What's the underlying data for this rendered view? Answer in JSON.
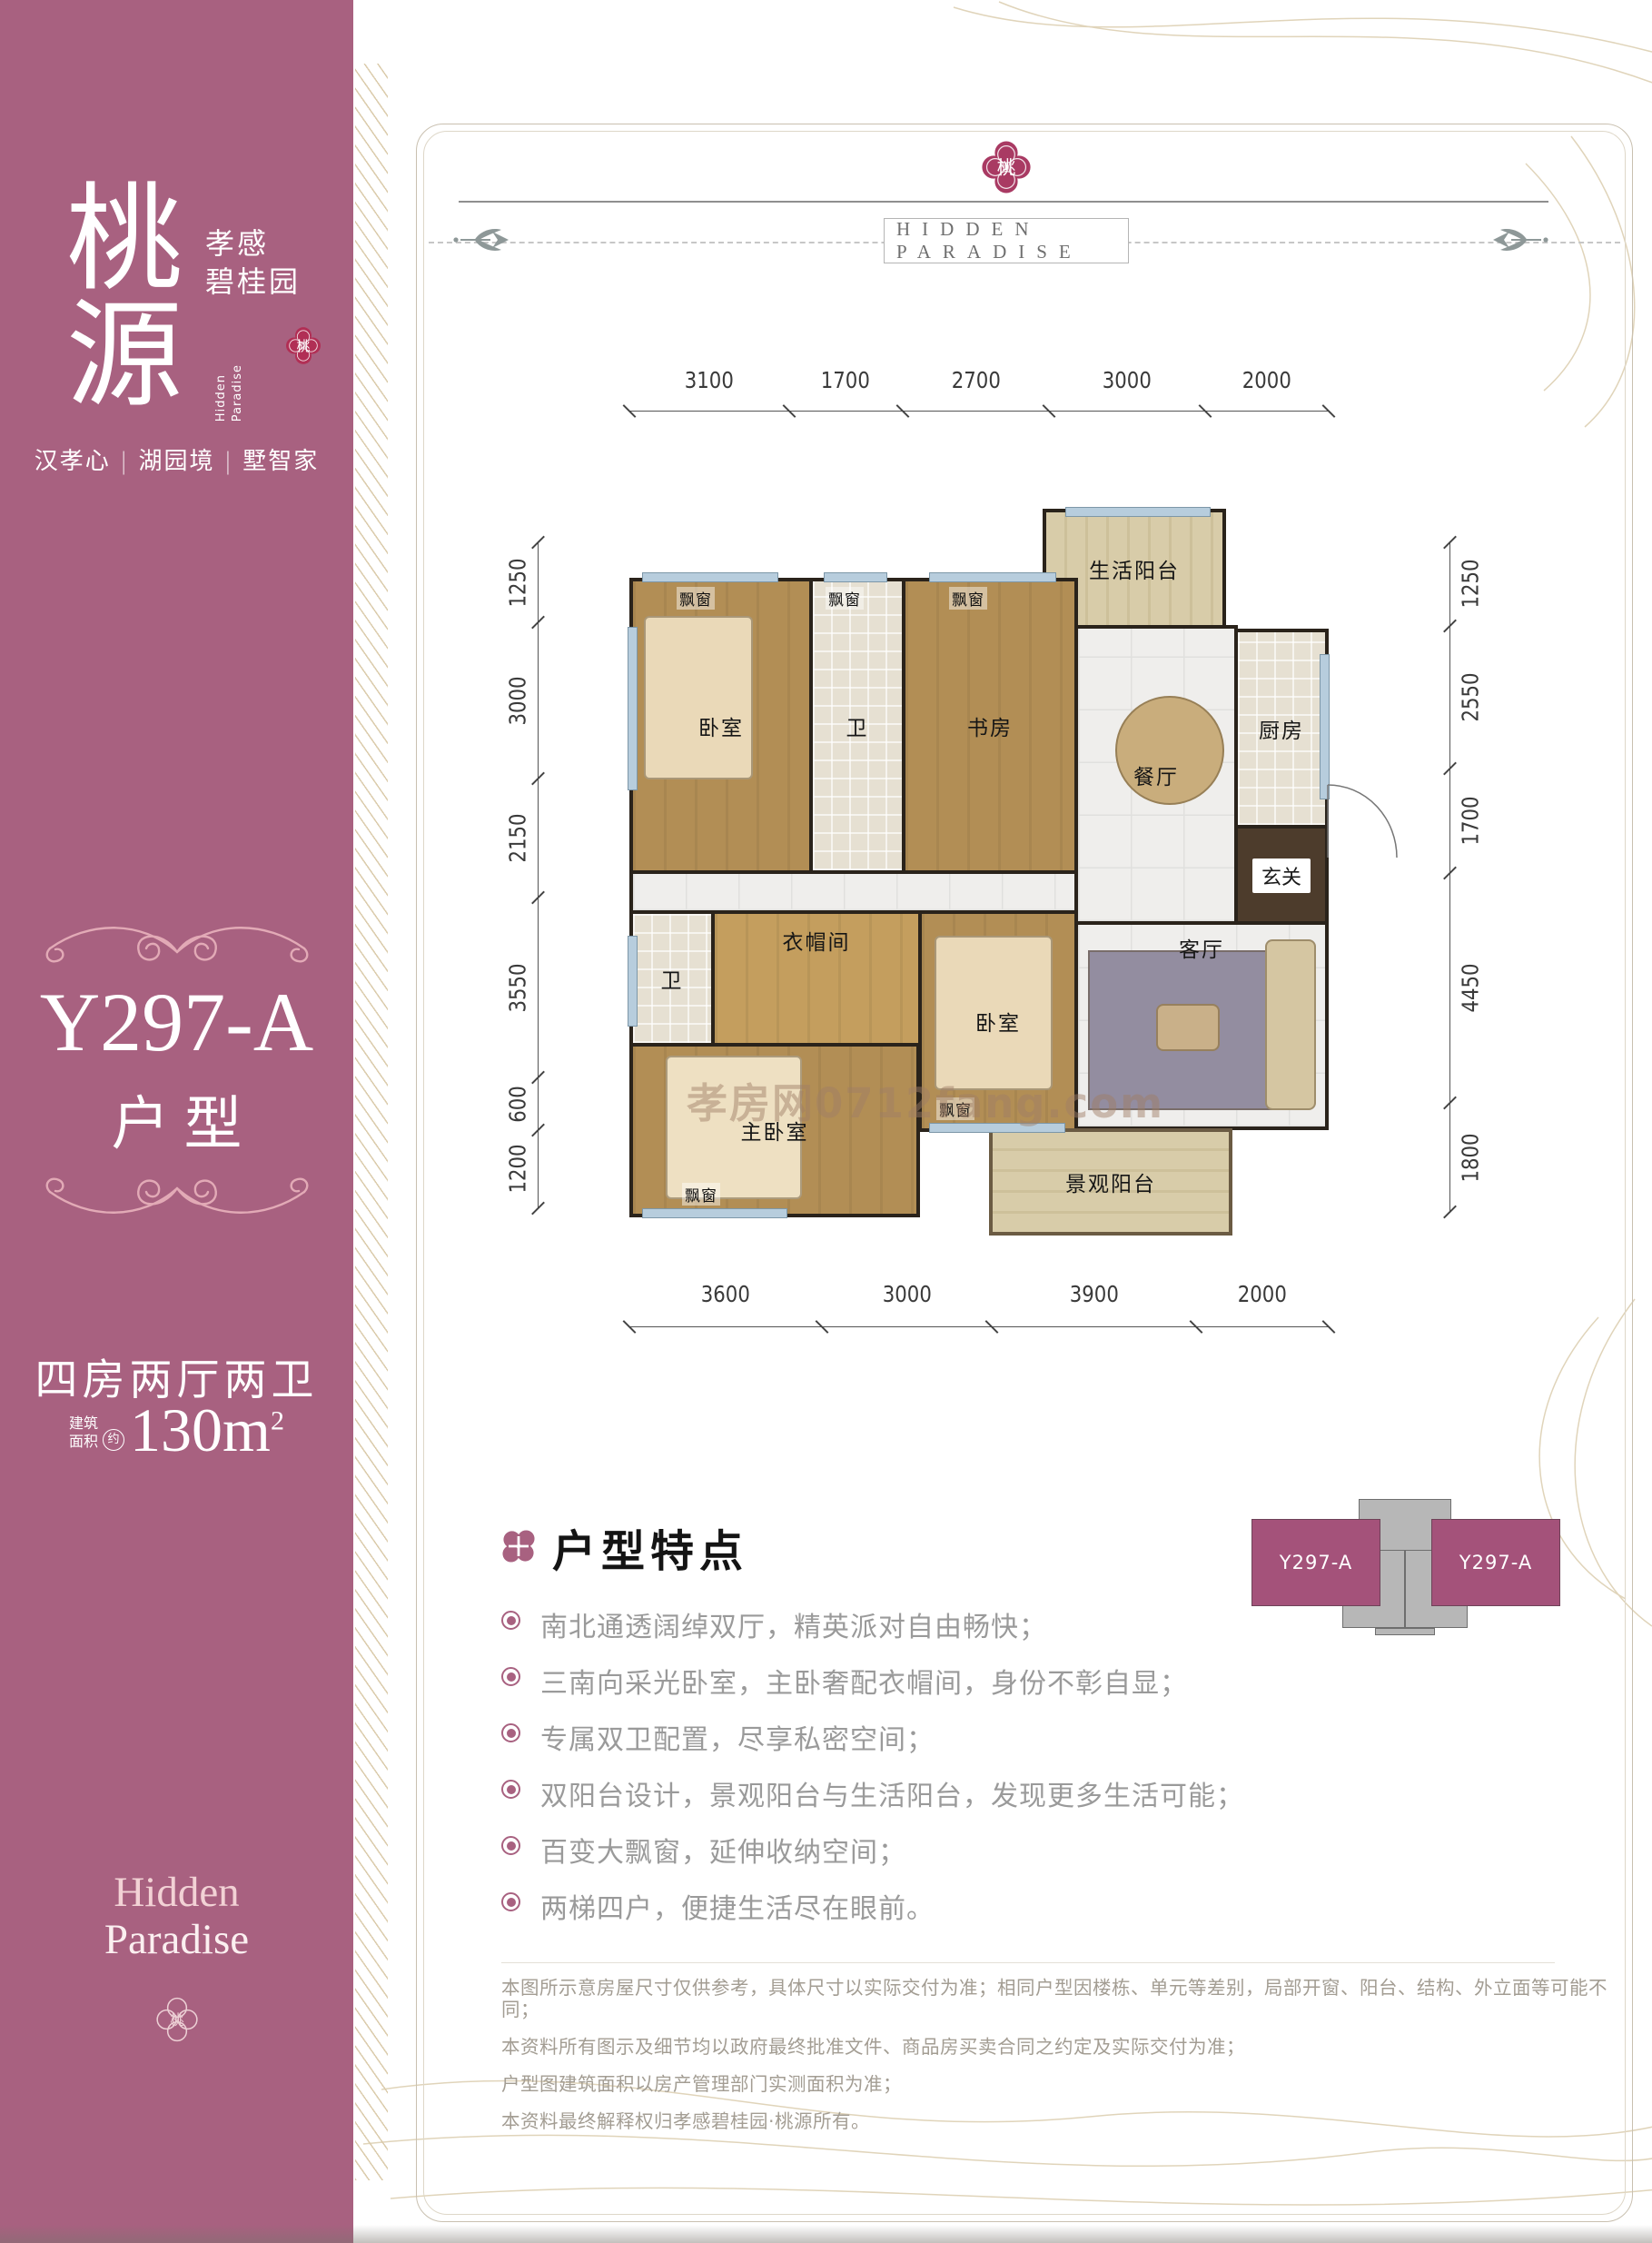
{
  "colors": {
    "sidebar_pink": "#a86180",
    "seal_red": "#b12f55",
    "seal_plum": "#a93a63",
    "gold_line": "#dbcdae",
    "keyplan_pink": "#a4527a"
  },
  "sidebar": {
    "logo_chars": [
      "桃",
      "源"
    ],
    "brand_lines": [
      "孝感",
      "碧桂园"
    ],
    "brand_en": "Hidden Paradise",
    "seal_char": "桃",
    "tagline": [
      "汉孝心",
      "湖园境",
      "墅智家"
    ],
    "tagline_sep": "|",
    "unit_code": "Y297-A",
    "unit_type_label": "户型",
    "layout_summary": "四房两厅两卫",
    "area_label_lines": [
      "建筑",
      "面积"
    ],
    "area_approx": "约",
    "area_value": "130m",
    "area_exp": "2",
    "footer_lines": [
      "Hidden",
      "Paradise"
    ]
  },
  "header": {
    "seal_char": "桃",
    "title": "HIDDEN PARADISE"
  },
  "floor_plan": {
    "dimensions": {
      "top": [
        3100,
        1700,
        2700,
        3000,
        2000
      ],
      "bottom": [
        3600,
        3000,
        3900,
        2000
      ],
      "left": [
        1250,
        3000,
        2150,
        3550,
        600,
        1200
      ],
      "right": [
        1250,
        2550,
        1700,
        4450,
        1800
      ]
    },
    "rooms": {
      "living_balcony": "生活阳台",
      "bedroom1": "卧室",
      "bath1": "卫",
      "study": "书房",
      "dining": "餐厅",
      "kitchen": "厨房",
      "foyer": "玄关",
      "living": "客厅",
      "bath2": "卫",
      "closet": "衣帽间",
      "master": "主卧室",
      "bedroom2": "卧室",
      "scenic_balcony": "景观阳台"
    },
    "window_label": "飘窗",
    "watermark": "孝房网0712fang.com"
  },
  "features": {
    "title": "户型特点",
    "items": [
      "南北通透阔绰双厅，精英派对自由畅快；",
      "三南向采光卧室，主卧奢配衣帽间，身份不彰自显；",
      "专属双卫配置，尽享私密空间；",
      "双阳台设计，景观阳台与生活阳台，发现更多生活可能；",
      "百变大飘窗，延伸收纳空间；",
      "两梯四户，便捷生活尽在眼前。"
    ]
  },
  "key_plan": {
    "left_label": "Y297-A",
    "right_label": "Y297-A"
  },
  "disclaimer": {
    "lines": [
      "本图所示意房屋尺寸仅供参考，具体尺寸以实际交付为准；相同户型因楼栋、单元等差别，局部开窗、阳台、结构、外立面等可能不同；",
      "本资料所有图示及细节均以政府最终批准文件、商品房买卖合同之约定及实际交付为准；",
      "户型图建筑面积以房产管理部门实测面积为准；",
      "本资料最终解释权归孝感碧桂园·桃源所有。"
    ]
  }
}
